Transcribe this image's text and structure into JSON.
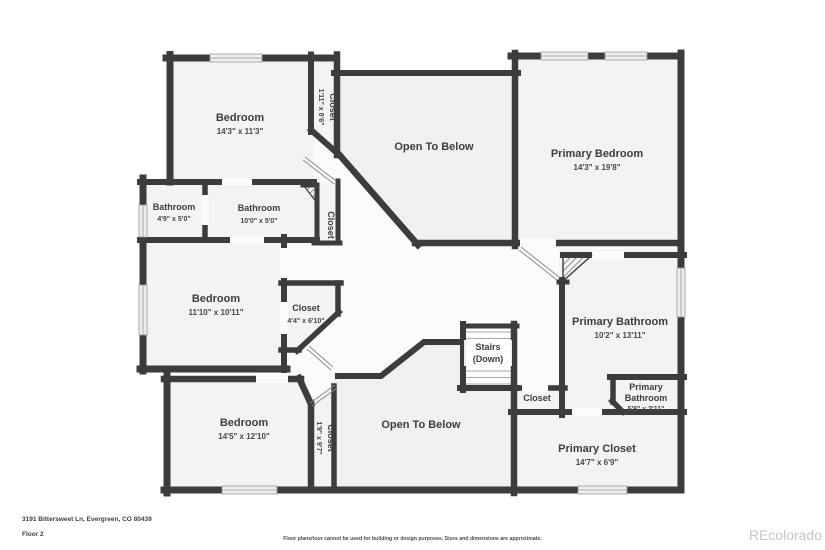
{
  "floorplan": {
    "address": "3191 Bittersweet Ln, Evergreen, CO 80439",
    "floor_label": "Floor 2",
    "disclaimer": "Floor plans/tour cannot be used for building or design purposes. Sizes and dimensions are approximate.",
    "watermark": "REcolorado",
    "palette": {
      "wall": "#3c3c3c",
      "room_fill": "#f3f3f3",
      "open_fill": "#f0f0f0",
      "hall_fill": "#fbfbfb",
      "watermark": "#c6c6c6"
    },
    "rooms": {
      "bedroom1": {
        "name": "Bedroom",
        "dims": "14'3\" x 11'3\""
      },
      "closet1": {
        "name": "Closet",
        "dims": "1'11\" x 8'6\""
      },
      "open1": {
        "name": "Open To Below"
      },
      "pbed": {
        "name": "Primary Bedroom",
        "dims": "14'3\" x 19'8\""
      },
      "bath1": {
        "name": "Bathroom",
        "dims": "4'9\" x 5'0\""
      },
      "bath2": {
        "name": "Bathroom",
        "dims": "10'0\" x 5'0\""
      },
      "closet2": {
        "name": "Closet"
      },
      "bedroom2": {
        "name": "Bedroom",
        "dims": "11'10\" x 10'11\""
      },
      "closet3": {
        "name": "Closet",
        "dims": "4'4\" x 6'10\""
      },
      "bedroom3": {
        "name": "Bedroom",
        "dims": "14'5\" x 12'10\""
      },
      "closet4": {
        "name": "Closet",
        "dims": "1'9\" x 9'7\""
      },
      "open2": {
        "name": "Open To Below"
      },
      "stairs": {
        "line1": "Stairs",
        "line2": "(Down)"
      },
      "closet5": {
        "name": "Closet"
      },
      "pbath": {
        "name": "Primary Bathroom",
        "dims": "10'2\" x 13'11\""
      },
      "pbath2": {
        "line1": "Primary",
        "line2": "Bathroom",
        "dims": "5'8\" x 2'11\""
      },
      "pcloset": {
        "name": "Primary Closet",
        "dims": "14'7\" x 6'9\""
      }
    }
  }
}
